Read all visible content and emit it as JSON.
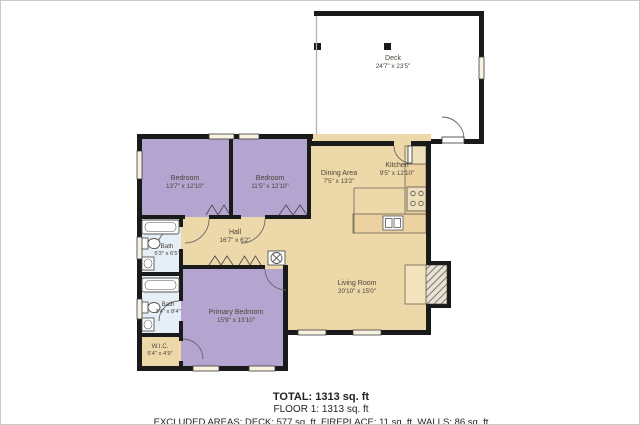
{
  "palette": {
    "wall": "#1a1a1a",
    "floor_tan": "#edd8aa",
    "bedroom_purple": "#b3a4d0",
    "bath_blue": "#e6eef7",
    "window_fill": "#f7f1df",
    "label_text": "#4a4438",
    "background": "#ffffff"
  },
  "rooms": [
    {
      "id": "deck",
      "name": "Deck",
      "dims": "24'7\" x 23'5\""
    },
    {
      "id": "bedroom-1",
      "name": "Bedroom",
      "dims": "13'7\" x 12'10\""
    },
    {
      "id": "bedroom-2",
      "name": "Bedroom",
      "dims": "11'5\" x 12'10\""
    },
    {
      "id": "kitchen",
      "name": "Kitchen",
      "dims": "9'5\" x 12'10\""
    },
    {
      "id": "dining-area",
      "name": "Dining Area",
      "dims": "7'5\" x 13'2\""
    },
    {
      "id": "hall",
      "name": "Hall",
      "dims": "16'7\" x 6'2\""
    },
    {
      "id": "bath-1",
      "name": "Bath",
      "dims": "5'3\" x 6'5\""
    },
    {
      "id": "bath-2",
      "name": "Bath",
      "dims": "3'4\" x 8'4\""
    },
    {
      "id": "living-room",
      "name": "Living Room",
      "dims": "20'10\" x 15'0\""
    },
    {
      "id": "primary-bedroom",
      "name": "Primary Bedroom",
      "dims": "15'9\" x 13'10\""
    },
    {
      "id": "wic",
      "name": "W.I.C.",
      "dims": "5'4\" x 4'9\""
    }
  ],
  "symbols": [
    "bathtub",
    "toilet",
    "sink",
    "kitchen-sink",
    "stove",
    "refrigerator",
    "water-heater",
    "fireplace",
    "deck-post",
    "door-swing",
    "window",
    "closet-bifold-doors"
  ],
  "summary": {
    "total": "TOTAL: 1313 sq. ft",
    "floor": "FLOOR 1: 1313 sq. ft",
    "excluded": "EXCLUDED AREAS: DECK: 577 sq. ft, FIREPLACE: 11 sq. ft, WALLS: 86 sq. ft"
  }
}
